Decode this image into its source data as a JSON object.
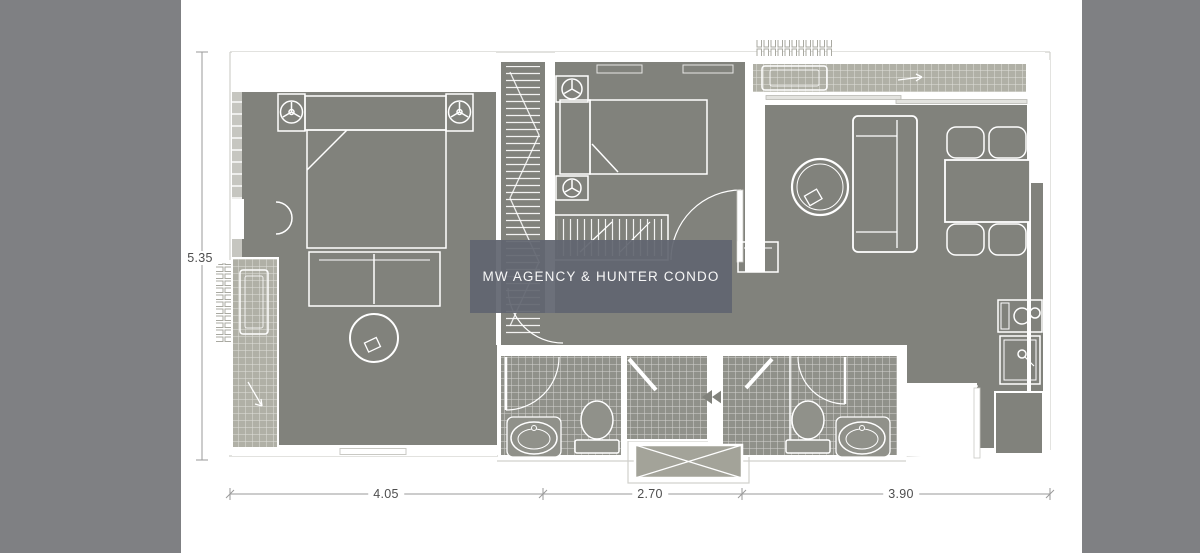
{
  "watermark": {
    "text": "MW AGENCY & HUNTER CONDO"
  },
  "dimensions": {
    "vertical": {
      "label": "5.35"
    },
    "horizontal": [
      {
        "label": "4.05"
      },
      {
        "label": "2.70"
      },
      {
        "label": "3.90"
      }
    ]
  },
  "colors": {
    "side_band": "#7f8083",
    "floor": "#81827c",
    "floor_light": "#a3a399",
    "tile_balcony": "#b0b0a6",
    "tile_bath": "#90918a",
    "wall_band": "#c6c6c0",
    "outline": "#d0d0cc",
    "dimension_line": "#9a9a9a",
    "dimension_text": "#4e4e4e",
    "watermark_bg": "rgba(97,101,112,0.93)"
  },
  "floorplan": {
    "rooms": [
      "master-bedroom",
      "second-bedroom",
      "wardrobe",
      "entry-hall",
      "living-dining",
      "kitchen",
      "bathroom-1",
      "bathroom-2",
      "balcony-left",
      "balcony-right",
      "service-shaft"
    ]
  }
}
